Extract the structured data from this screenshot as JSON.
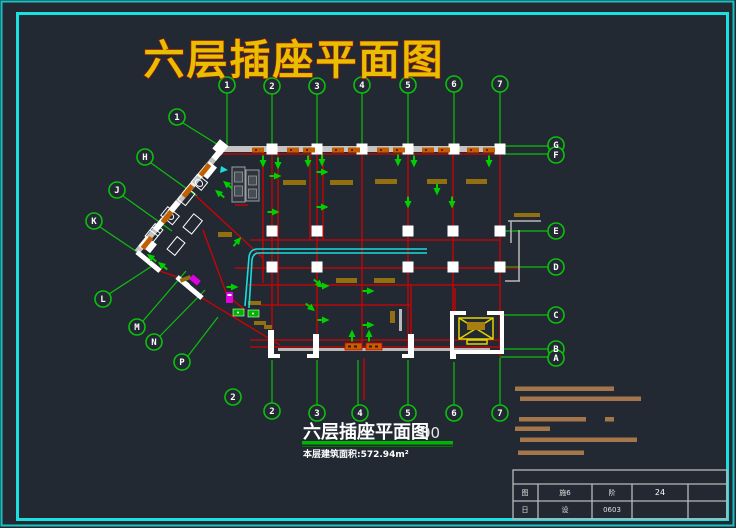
{
  "window": {
    "background": "#232933",
    "type": "cad-drawing-viewport"
  },
  "colors": {
    "frame_cyan": "#1be0e0",
    "axis_green": "#0cc00c",
    "wall_red": "#d40000",
    "wall_gray": "#c4c4c4",
    "tray_cyan": "#19dcdc",
    "socket_green": "#00d000",
    "note_tan": "#a5764b",
    "bar_olive": "#93700f",
    "window_orange": "#c45f00",
    "elevator_yellow": "#e2d400",
    "magenta": "#e000e0",
    "title_yellow": "#e6c000",
    "title_shadow_red": "#c01800"
  },
  "title_top": "六层插座平面图",
  "axes": {
    "top": [
      "1",
      "2",
      "3",
      "4",
      "5",
      "6",
      "7"
    ],
    "bottom": [
      "2",
      "3",
      "4",
      "5",
      "6",
      "7"
    ],
    "right": [
      "G",
      "F",
      "E",
      "D",
      "C",
      "B",
      "A"
    ],
    "diagonal": [
      "1",
      "H",
      "J",
      "K",
      "L",
      "M",
      "N",
      "P"
    ],
    "floating": "2"
  },
  "footer": {
    "title": "六层插座平面图",
    "scale": "00",
    "area_note": "本层建筑面积:572.94m²"
  },
  "title_block": {
    "row2": [
      "图",
      "施6",
      "阶",
      "24",
      ""
    ],
    "row3": [
      "日",
      "设",
      "0603",
      "",
      ""
    ]
  }
}
